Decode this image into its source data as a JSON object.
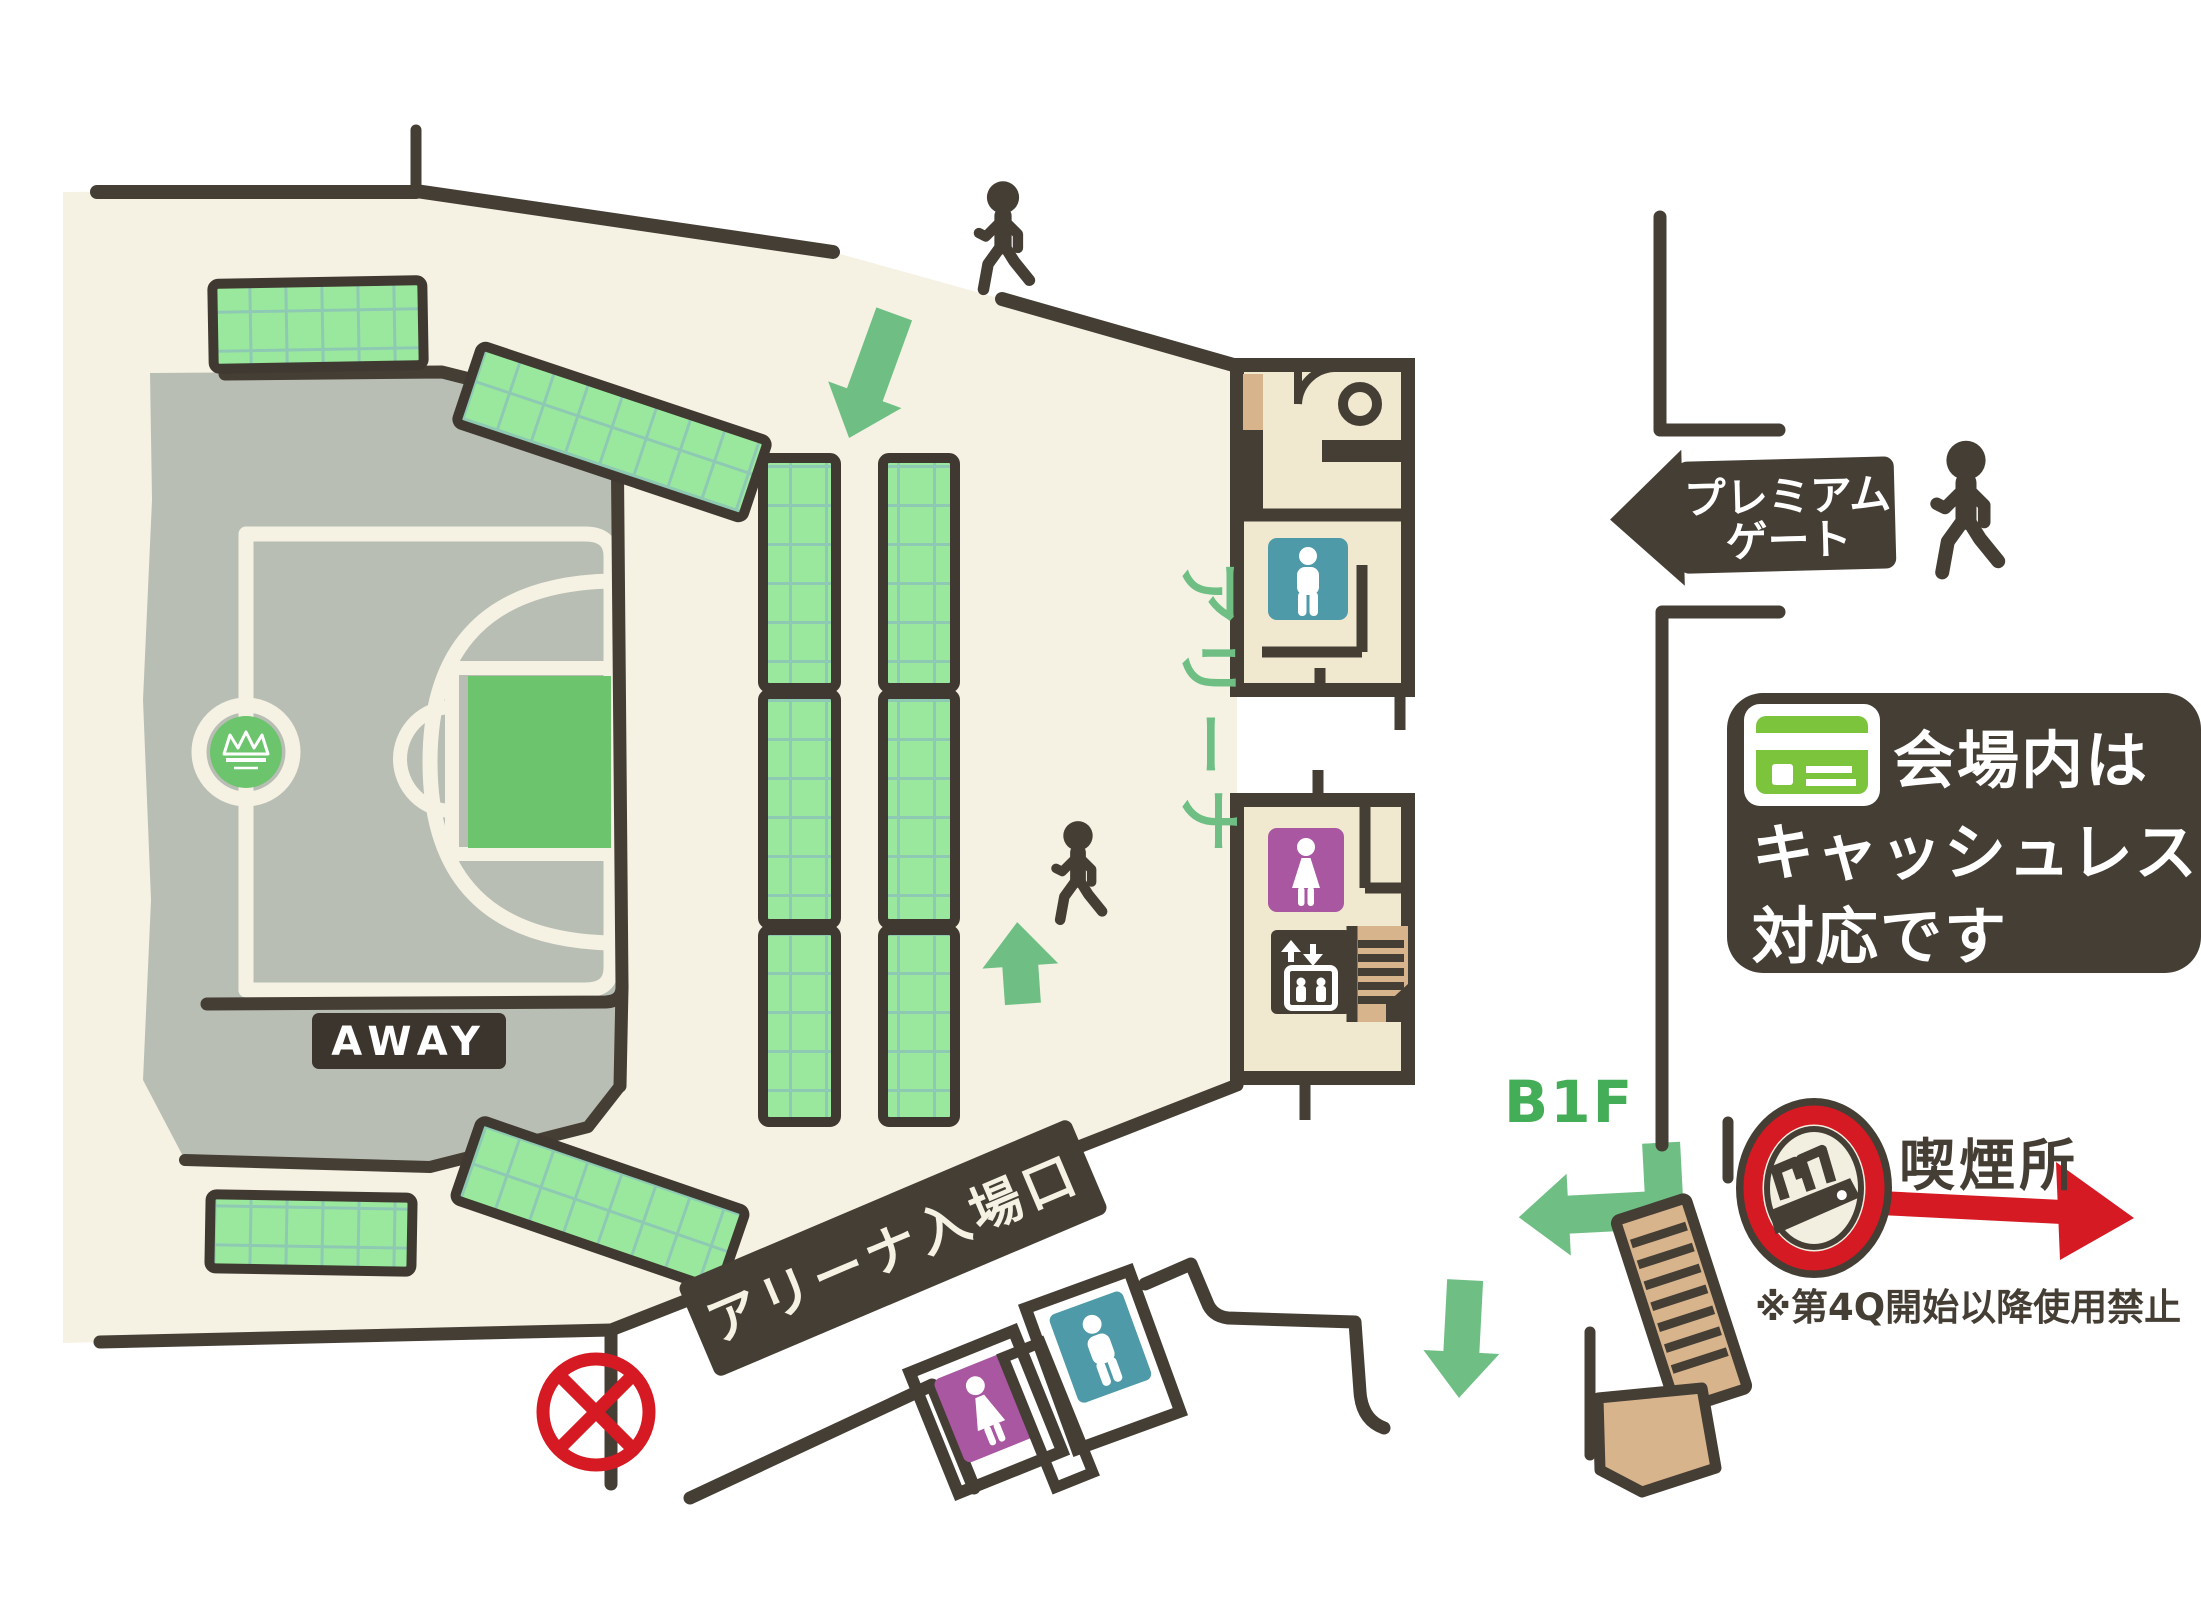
{
  "labels": {
    "premium_gate_line1": "プレミアム",
    "premium_gate_line2": "ゲート",
    "cashless_line1": "会場内は",
    "cashless_line2": "キャッシュレス",
    "cashless_line3": "対応です",
    "b1f": "B1F",
    "smoking_area": "喫煙所",
    "smoking_note": "※第4Q開始以降使用禁止",
    "arena_vertical": "アリーナ",
    "arena_entrance": "アリーナ入場口",
    "away": "AWAY"
  },
  "colors": {
    "wall_dark": "#453e35",
    "concourse_cream": "#f5f2e3",
    "court_gray": "#b9beb5",
    "seat_green": "#9ae89d",
    "seat_grid": "#8ec9b4",
    "accent_green": "#6cc46d",
    "arrow_green": "#6fbf85",
    "b1f_green": "#43ad57",
    "card_green": "#7cc43c",
    "male_teal": "#4e9aa8",
    "female_purple": "#a857a0",
    "room_cream": "#f0e8cf",
    "stairs_tan": "#d8b48d",
    "alert_red": "#d61a24",
    "sign_text": "#f5f2e3"
  },
  "icons": {
    "walking-person-icon": "🚶",
    "mens-toilet-icon": "🚹",
    "womens-toilet-icon": "🚺",
    "accessible-toilet-icon": "⭕",
    "elevator-icon": "🛗",
    "stairs-icon": "🪜",
    "credit-card-icon": "💳",
    "smoking-area-icon": "🚬",
    "no-entry-icon": "⊗",
    "down-arrow-icon": "⬇",
    "up-arrow-icon": "⬆",
    "b1f-turn-arrow-icon": "↰",
    "premium-gate-arrow-icon": "⬅",
    "smoking-direction-arrow-icon": "➡",
    "team-logo-icon": "👑"
  }
}
